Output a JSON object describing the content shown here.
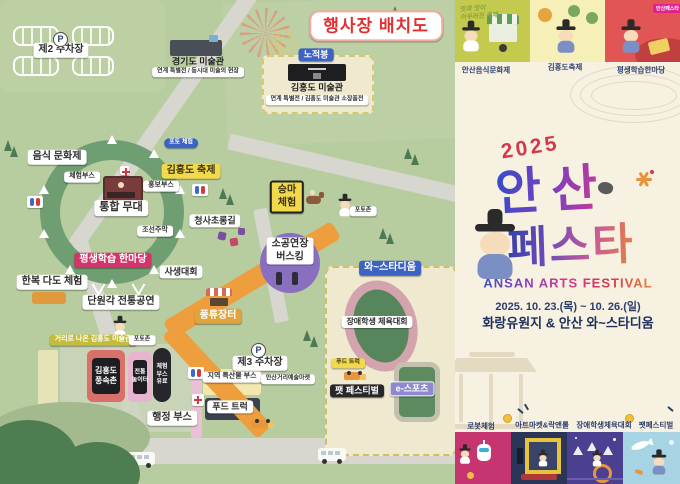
{
  "map": {
    "title": "행사장 배치도",
    "parking_p": "P",
    "parking2": "제2 주차장",
    "parking3": "제3 주차장",
    "gyeonggi_museum": "경기도 미술관",
    "gyeonggi_museum_sub": "연계 특별전 / 동시대 미술의 현장",
    "nojeokbong": "노적봉",
    "kimhongdo_museum": "김홍도 미술관",
    "kimhongdo_museum_sub": "연계 특별전 / 김홍도 미술관 소장품전",
    "food_culture": "음식 문화제",
    "experience_booth": "체험부스",
    "main_stage": "통합 무대",
    "pr_booth": "홍보부스",
    "kimhongdo_festival": "김홍도 축제",
    "photo_experience": "포토 체험",
    "joseon_tavern": "조선주막",
    "lantern_road": "청사초롱길",
    "horse_riding_1": "승마",
    "horse_riding_2": "체험",
    "photo_zone": "포토존",
    "busking_1": "소공연장",
    "busking_2": "버스킹",
    "sketch_contest": "사생대회",
    "lifelong_learning": "평생학습 한마당",
    "hanbok_tea": "한복 다도 체험",
    "danwongak": "단원각 전통공연",
    "market": "풍류장터",
    "street_museum": "거리로 나온 김홍도 미술관",
    "folk_village_1": "김홍도",
    "folk_village_2": "풍속촌",
    "playground_1": "전통",
    "playground_2": "놀이터",
    "paid_booth_1": "체험",
    "paid_booth_2": "부스",
    "paid_booth_3": "유료",
    "admin_booth": "행정 부스",
    "local_products": "지역 특산물 부스",
    "street_art_market": "안산거리예술마켓",
    "food_truck": "푸드 트럭",
    "stadium": "와~스타디움",
    "disabled_sports": "장애학생 체육대회",
    "pet_festival": "팻 페스티벌",
    "esports": "e-스포츠"
  },
  "poster": {
    "slogan_1": "맛과 멋이",
    "slogan_2": "어우러진 축제",
    "panel_labels": [
      "안산음식문화제",
      "김홍도축제",
      "평생학습한마당"
    ],
    "badge": "안산페스타",
    "year": "2025",
    "title_1": "안산",
    "title_2": "페스타",
    "subtitle": "ANSAN ARTS FESTIVAL",
    "date": "2025. 10. 23.(목) ~ 10. 26.(일)",
    "venue": "화랑유원지 & 안산 와~스타디움",
    "event_labels": [
      "로봇체험",
      "아트마켓&락앤롤",
      "장애학생체육대회",
      "팻페스티벌"
    ]
  },
  "colors": {
    "map_bg": "#b7cda0",
    "road": "#d7d7cf",
    "title_red": "#e03131",
    "accent_magenta": "#d6336c",
    "accent_blue": "#3c63c3",
    "poster_bg": "#f6f1e1",
    "navy_text": "#2c3e6e",
    "orange_path": "#ef9e3e"
  }
}
